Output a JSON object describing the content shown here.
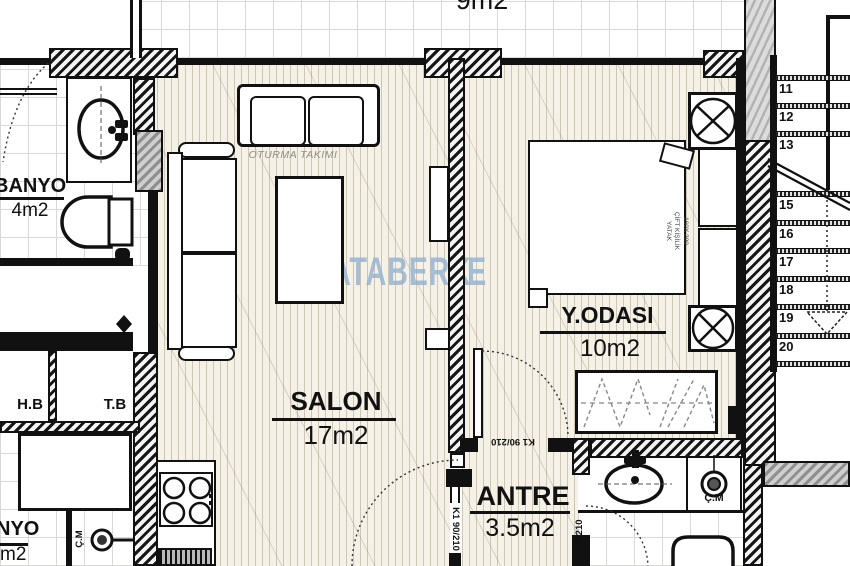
{
  "watermark": {
    "brand": "ATABERK",
    "fragment": "E",
    "color": "#9cb8d4"
  },
  "rooms": {
    "balcony": {
      "area": "9m2"
    },
    "banyo": {
      "name": "BANYO",
      "area": "4m2"
    },
    "salon": {
      "name": "SALON",
      "area": "17m2"
    },
    "bedroom": {
      "name": "Y.ODASI",
      "area": "10m2"
    },
    "antre": {
      "name": "ANTRE",
      "area": "3.5m2"
    },
    "hb": {
      "name": "H.B"
    },
    "tb": {
      "name": "T.B"
    },
    "banyo2": {
      "name": "NYO",
      "area": "m2"
    }
  },
  "labels": {
    "seating": "OTURMA TAKIMI",
    "bed_line1": "160X 200",
    "bed_line2": "ÇİFT KİŞİLİK",
    "bed_line3": "YATAK",
    "door_k1_top": "K1 90/210",
    "door_k1_side": "K1 90/210",
    "door_80": "80/210",
    "washer_right": "Ç.M",
    "washer_left": "Ç.M"
  },
  "stairs": {
    "steps": [
      "11",
      "12",
      "13",
      "15",
      "16",
      "17",
      "18",
      "19",
      "20"
    ]
  },
  "colors": {
    "wall": "#111111",
    "watermark": "#9cb8d4",
    "floor": "#f5f1e7"
  }
}
